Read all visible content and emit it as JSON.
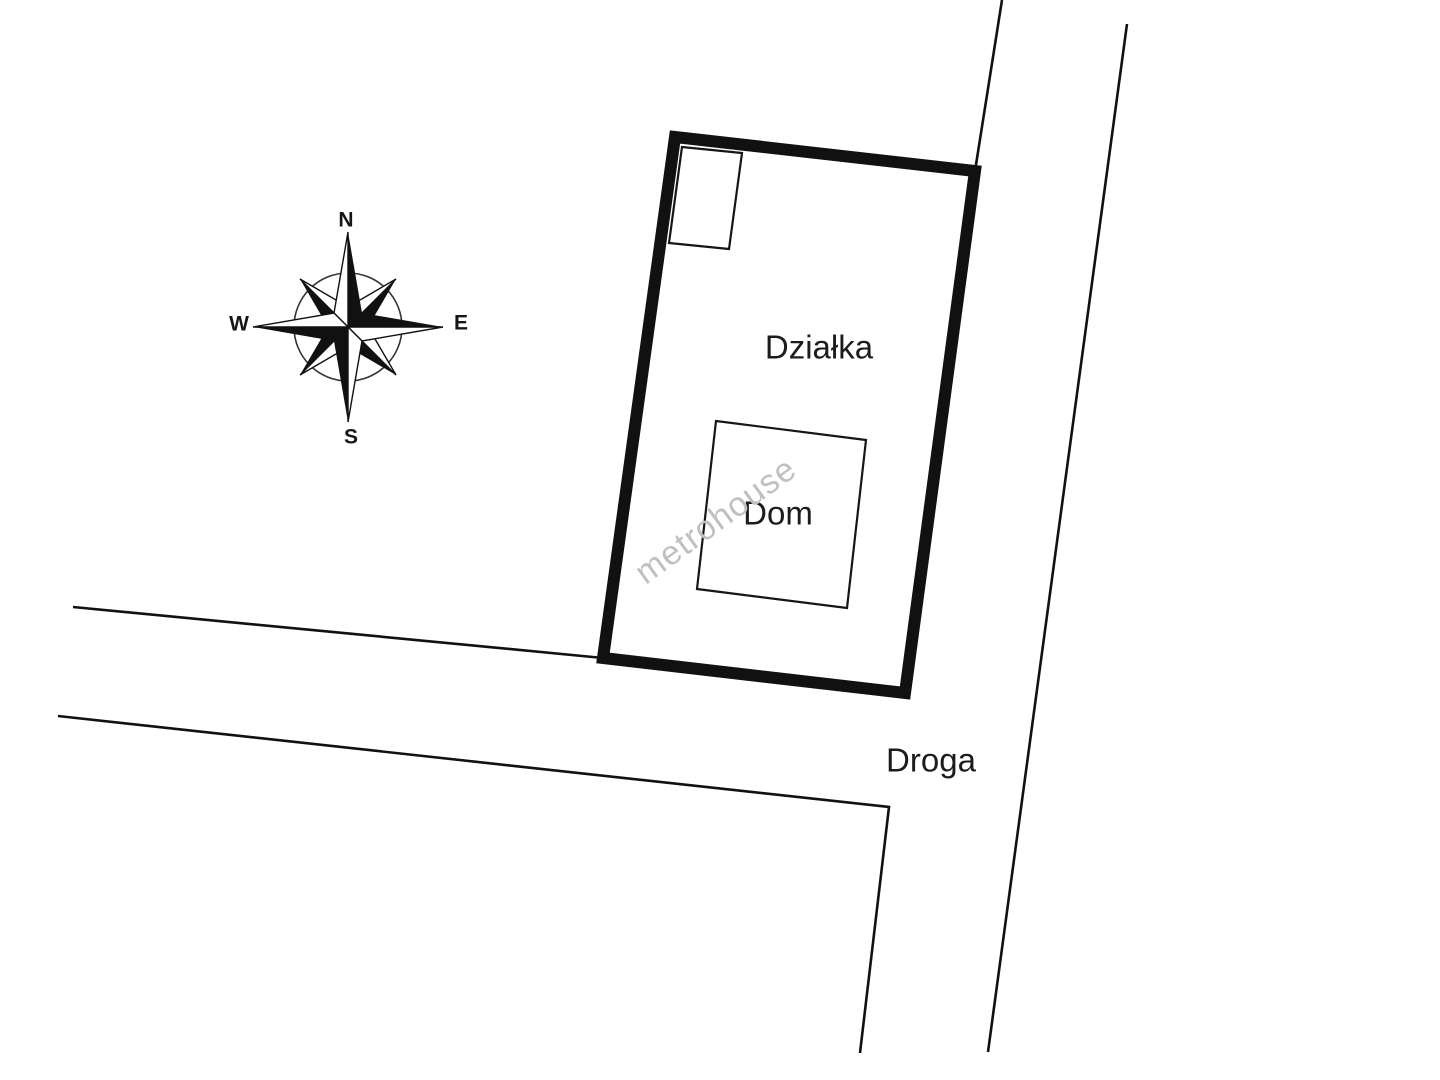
{
  "map": {
    "parcel_label": "Działka",
    "house_label": "Dom",
    "road_label": "Droga"
  },
  "compass": {
    "north": "N",
    "south": "S",
    "east": "E",
    "west": "W"
  },
  "watermark": {
    "text": "metrohouse",
    "color": "#c0c0c0"
  },
  "colors": {
    "background": "#ffffff",
    "line": "#111111",
    "thick_border": "#111111"
  }
}
